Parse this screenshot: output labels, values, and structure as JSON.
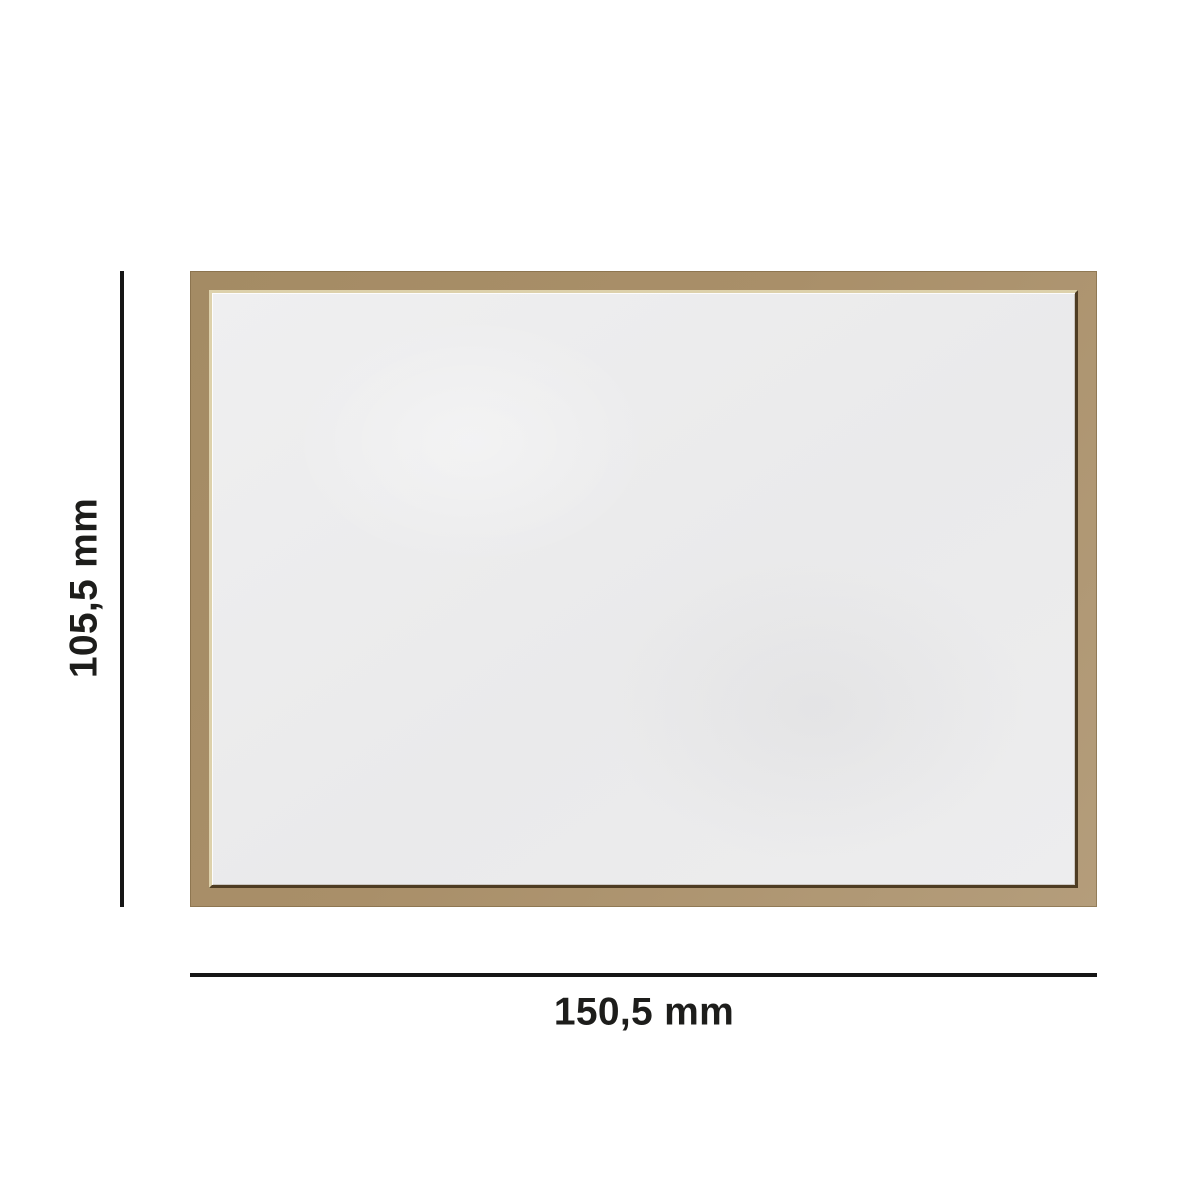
{
  "labels": {
    "height": "105,5 mm",
    "width": "150,5 mm"
  },
  "colors": {
    "background": "#ffffff",
    "frame": "#a98f69",
    "frame-light": "#b49d7b",
    "frame-dark": "#a48b64",
    "frame-edge": "#8a744f",
    "lip-highlight": "#ddd1ab",
    "lip-shadow": "#4e3c22",
    "board": "#ededee",
    "line": "#161616",
    "text": "#1d1d1b"
  }
}
